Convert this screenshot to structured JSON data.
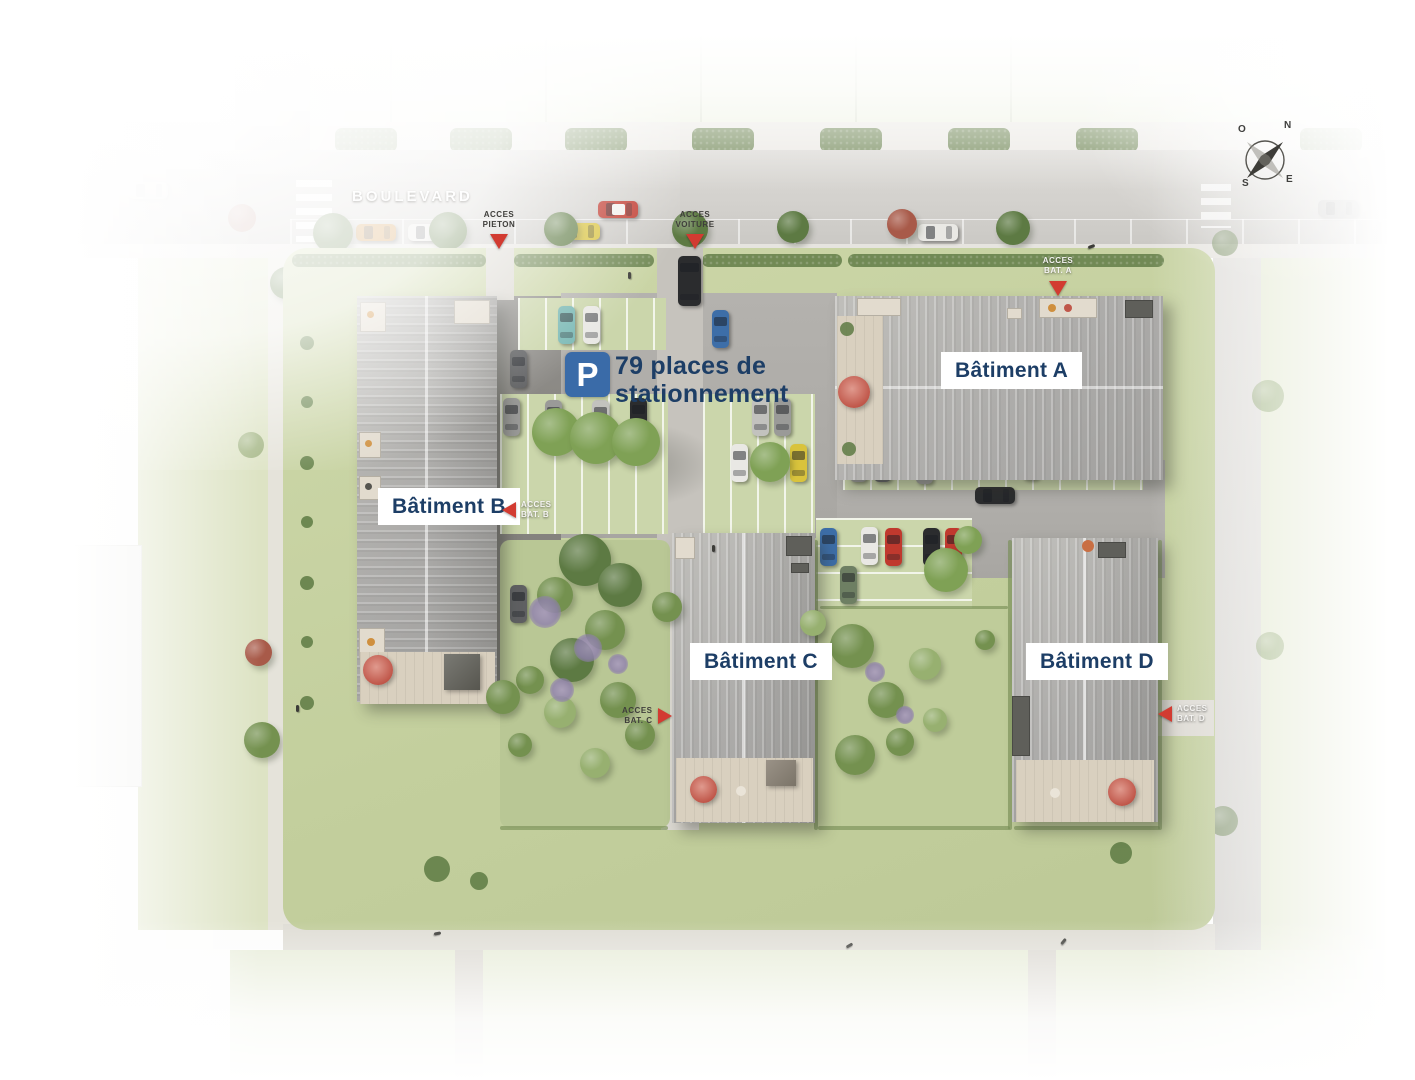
{
  "plan": {
    "street": {
      "name": "BOULEVARD"
    },
    "parking_sign": {
      "letter": "P",
      "line1": "79 places de",
      "line2": "stationnement"
    },
    "buildings": [
      {
        "label": "Bâtiment A"
      },
      {
        "label": "Bâtiment B"
      },
      {
        "label": "Bâtiment C"
      },
      {
        "label": "Bâtiment D"
      }
    ],
    "access": {
      "pieton": {
        "line1": "ACCES",
        "line2": "PIETON"
      },
      "voiture": {
        "line1": "ACCES",
        "line2": "VOITURE"
      },
      "bat_a": {
        "line1": "ACCES",
        "line2": "BAT. A"
      },
      "bat_b": {
        "line1": "ACCES",
        "line2": "BAT. B"
      },
      "bat_c": {
        "line1": "ACCES",
        "line2": "BAT. C"
      },
      "bat_d": {
        "line1": "ACCES",
        "line2": "BAT. D"
      }
    },
    "compass": {
      "n": "N",
      "e": "E",
      "s": "S",
      "o": "O"
    },
    "colors": {
      "label_navy": "#1d3e66",
      "marker_red": "#d23b31",
      "parking_blue": "#3a6ba8"
    }
  }
}
